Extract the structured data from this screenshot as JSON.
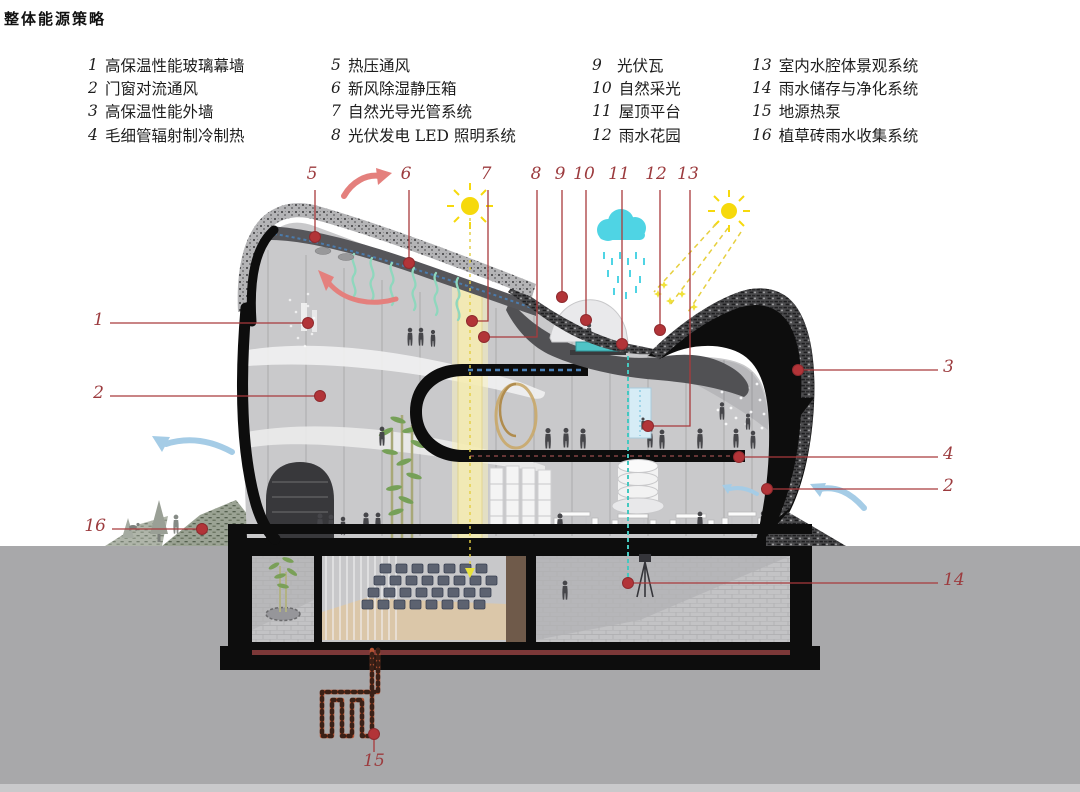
{
  "title": "整体能源策略",
  "legend": {
    "columns": [
      {
        "items": [
          {
            "num": "1",
            "label": "高保温性能玻璃幕墙"
          },
          {
            "num": "2",
            "label": "门窗对流通风"
          },
          {
            "num": "3",
            "label": "高保温性能外墙"
          },
          {
            "num": "4",
            "label": "毛细管辐射制冷制热"
          }
        ]
      },
      {
        "items": [
          {
            "num": "5",
            "label": "热压通风"
          },
          {
            "num": "6",
            "label": "新风除湿静压箱"
          },
          {
            "num": "7",
            "label": "自然光导光管系统"
          },
          {
            "num": "8",
            "label": "光伏发电 LED 照明系统"
          }
        ]
      },
      {
        "items": [
          {
            "num": "9",
            "label": "光伏瓦"
          },
          {
            "num": "10",
            "label": "自然采光"
          },
          {
            "num": "11",
            "label": "屋顶平台"
          },
          {
            "num": "12",
            "label": "雨水花园"
          }
        ]
      },
      {
        "items": [
          {
            "num": "13",
            "label": "室内水腔体景观系统"
          },
          {
            "num": "14",
            "label": "雨水储存与净化系统"
          },
          {
            "num": "15",
            "label": "地源热泵"
          },
          {
            "num": "16",
            "label": "植草砖雨水收集系统"
          }
        ]
      }
    ]
  },
  "callouts": {
    "top": [
      {
        "num": "5"
      },
      {
        "num": "6"
      },
      {
        "num": "7"
      },
      {
        "num": "8"
      },
      {
        "num": "9"
      },
      {
        "num": "10"
      },
      {
        "num": "11"
      },
      {
        "num": "12"
      },
      {
        "num": "13"
      }
    ],
    "left": [
      {
        "num": "1"
      },
      {
        "num": "2"
      },
      {
        "num": "16"
      }
    ],
    "right": [
      {
        "num": "3"
      },
      {
        "num": "4"
      },
      {
        "num": "2"
      },
      {
        "num": "14"
      }
    ],
    "bottom": [
      {
        "num": "15"
      }
    ]
  },
  "palette": {
    "callout_line": "#a93a3c",
    "callout_dot": "#b23438",
    "sun": "#f6d90c",
    "rain_cloud": "#4fd4e4",
    "warm_air_arrow": "#e4807d",
    "cool_air_arrow": "#a5cce6",
    "steam": "#8fd7bd",
    "light_shaft": "#f5ecb2",
    "pool_water": "#4fc3c6",
    "heat_pump_pipe": "#b85433"
  }
}
